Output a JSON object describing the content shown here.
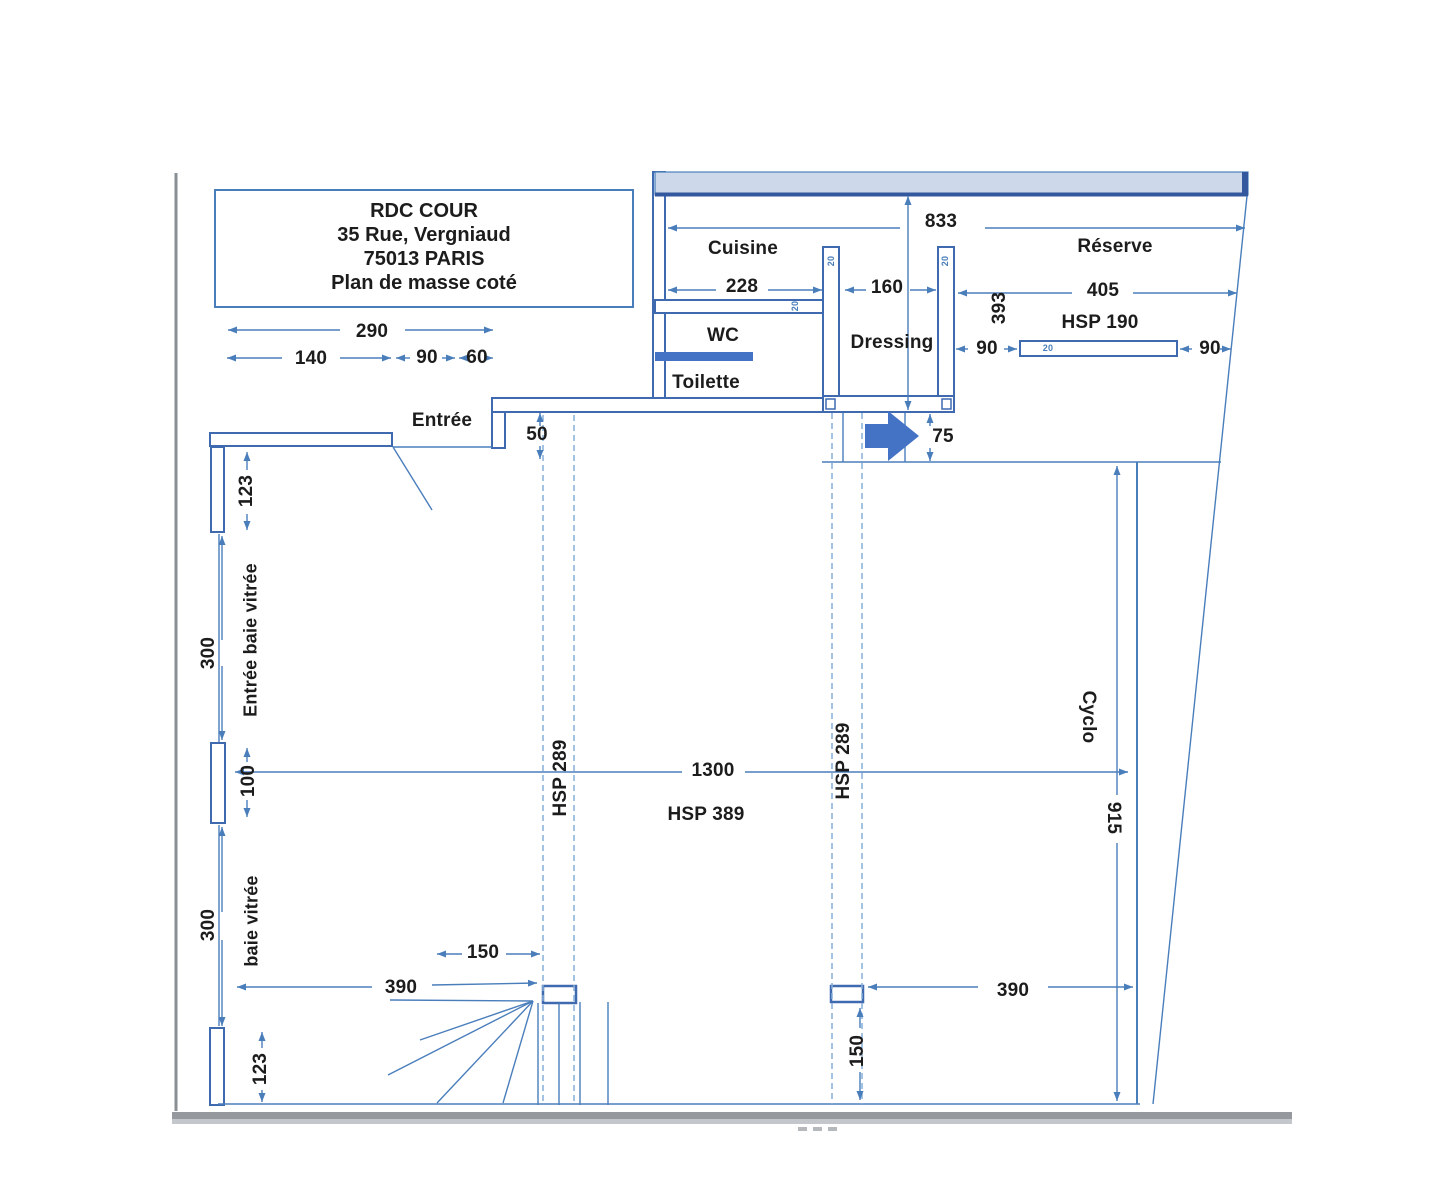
{
  "title_block": {
    "line1": "RDC COUR",
    "line2": "35 Rue, Vergniaud",
    "line3": "75013 PARIS",
    "line4": "Plan de masse coté"
  },
  "rooms": {
    "cuisine": "Cuisine",
    "wc": "WC",
    "toilette": "Toilette",
    "dressing": "Dressing",
    "reserve": "Réserve",
    "entree": "Entrée",
    "cyclo": "Cyclo"
  },
  "annotations": {
    "hsp190": "HSP 190",
    "hsp389": "HSP 389",
    "hsp289_left": "HSP 289",
    "hsp289_right": "HSP 289",
    "entree_baie_vitree": "Entrée baie vitrée",
    "baie_vitree": "baie vitrée"
  },
  "dimensions": {
    "d290": "290",
    "d140": "140",
    "d90_top": "90",
    "d60": "60",
    "d833": "833",
    "d228": "228",
    "d160": "160",
    "d393": "393",
    "d405": "405",
    "d90_shelf_left": "90",
    "d90_shelf_right": "90",
    "d50": "50",
    "d75": "75",
    "d123_top": "123",
    "d300_top": "300",
    "d100": "100",
    "d300_bottom": "300",
    "d123_bottom": "123",
    "d1300": "1300",
    "d915": "915",
    "d150_left": "150",
    "d390_left": "390",
    "d390_right": "390",
    "d150_right": "150",
    "wall_thickness_20": "20"
  },
  "colors": {
    "line_blue": "#4a7ebb",
    "wall_blue": "#3f6ab0",
    "band_fill": "#cdd9eb",
    "band_dark": "#33589e",
    "arrow_fill": "#4472c4",
    "dashed_blue": "#85aed8",
    "text_dark": "#1c1c1c",
    "page_gray": "#95999e"
  }
}
